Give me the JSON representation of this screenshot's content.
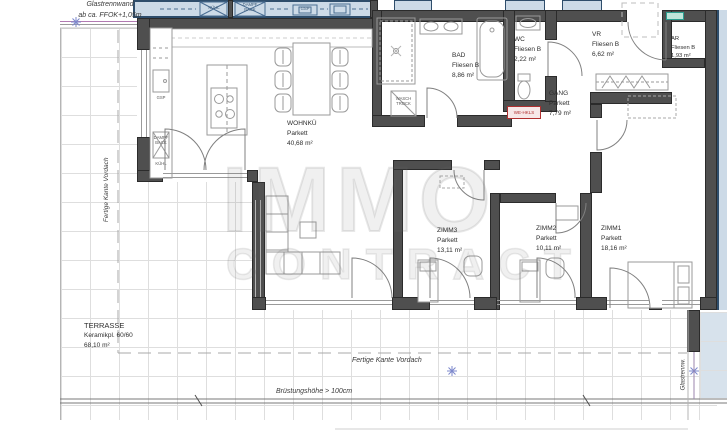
{
  "note": {
    "line1": "Glastrennwand",
    "line2": "ab ca. FFOK+1,05m"
  },
  "rooms": {
    "wohnku": {
      "name": "WOHNKÜ",
      "floor": "Parkett",
      "area": "40,68 m²"
    },
    "bad": {
      "name": "BAD",
      "floor": "Fliesen B",
      "area": "8,86 m²"
    },
    "wc": {
      "name": "WC",
      "floor": "Fliesen B",
      "area": "2,22 m²"
    },
    "vr": {
      "name": "VR",
      "floor": "Fliesen B",
      "area": "6,62 m²"
    },
    "ar": {
      "name": "AR",
      "floor": "Fliesen B",
      "area": "1,93 m²"
    },
    "gang": {
      "name": "GANG",
      "floor": "Parkett",
      "area": "7,79 m²"
    },
    "zimm3": {
      "name": "ZIMM3",
      "floor": "Parkett",
      "area": "13,11 m²"
    },
    "zimm2": {
      "name": "ZIMM2",
      "floor": "Parkett",
      "area": "10,11 m²"
    },
    "zimm1": {
      "name": "ZIMM1",
      "floor": "Parkett",
      "area": "18,16 m²"
    },
    "terrasse": {
      "name": "TERRASSE",
      "floor": "Keramikpl. 60/60",
      "area": "68,10 m²"
    }
  },
  "appliances": {
    "kuehl": "KÜHL",
    "dampf": "DAMPF",
    "back": "BACK",
    "gsp": "GSP",
    "wasch": "WASCH",
    "trock": "TROCK"
  },
  "annotations": {
    "canopy_left": "Fertige Kante Vordach",
    "canopy_bottom": "Fertige Kante Vordach",
    "parapet": "Brüstungshöhe > 100cm",
    "glass_divider_right": "Glastrennw.",
    "hkls_box": "WE-HKLS"
  },
  "watermark": {
    "line1": "IMMO",
    "line2": "CONTRACT"
  },
  "colors": {
    "wall": "#4f4f4f",
    "blue_fill": "#ccdae7",
    "blue_line": "#2e4d6b",
    "tile_line": "#dedede",
    "red": "#b03030",
    "teal": "#2b9d8f",
    "snowflake": "#7d88cc",
    "glass_pink": "#b27ab2"
  }
}
